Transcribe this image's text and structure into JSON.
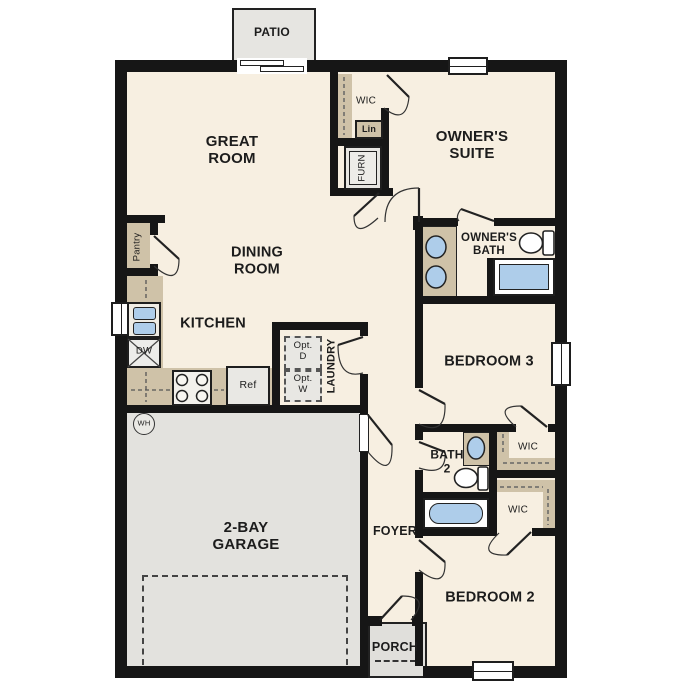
{
  "labels": {
    "patio": "PATIO",
    "great_room": "GREAT\nROOM",
    "wic_top": "WIC",
    "lin": "Lin",
    "furn": "FURN",
    "owners_suite": "OWNER'S\nSUITE",
    "owners_bath": "OWNER'S\nBATH",
    "dining_room": "DINING\nROOM",
    "pantry": "Pantry",
    "kitchen": "KITCHEN",
    "dw": "DW",
    "ref": "Ref",
    "opt_d": "Opt.\nD",
    "opt_w": "Opt.\nW",
    "laundry": "LAUNDRY",
    "bedroom3": "BEDROOM 3",
    "wh": "WH",
    "garage": "2-BAY\nGARAGE",
    "foyer": "FOYER",
    "bath2": "BATH\n2",
    "wic_bed3": "WIC",
    "wic_bed2": "WIC",
    "bedroom2": "BEDROOM 2",
    "porch": "PORCH"
  },
  "colors": {
    "floor": "#f7efe1",
    "wall": "#161616",
    "counter": "#cfc2a8",
    "fixture_blue": "#aecdea",
    "concrete": "#e3e2de",
    "appliance": "#ebeae6"
  }
}
